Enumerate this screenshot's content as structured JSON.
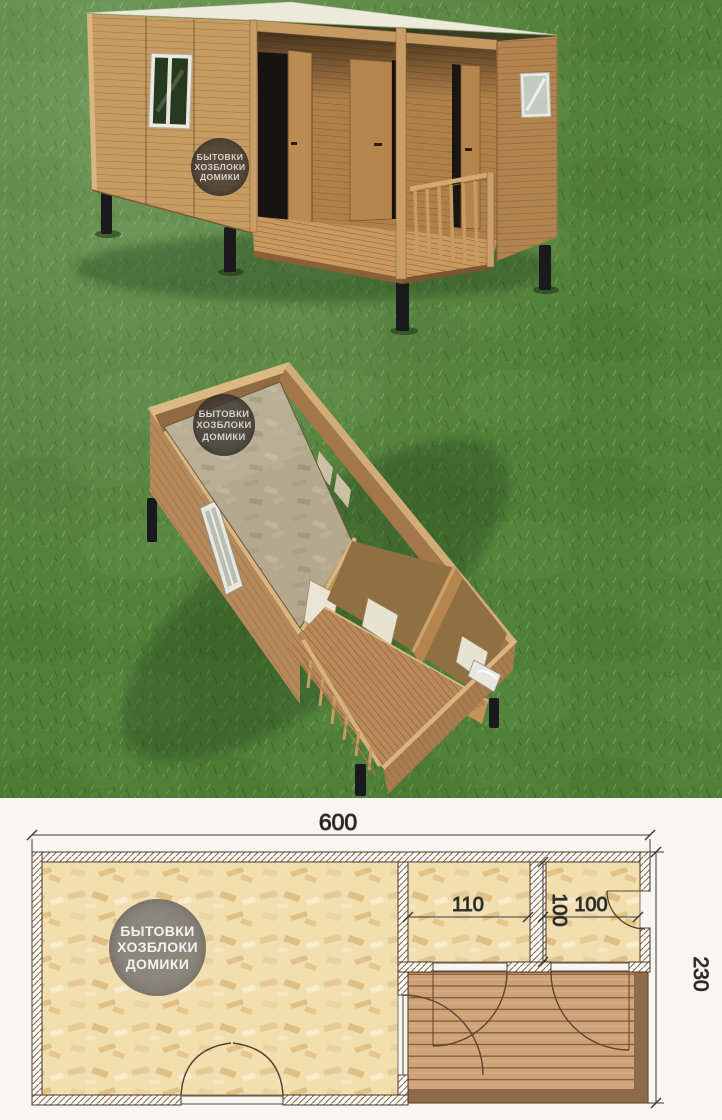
{
  "watermark": {
    "lines": [
      "БЫТОВКИ",
      "ХОЗБЛОКИ",
      "ДОМИКИ"
    ]
  },
  "plan": {
    "dim_width": "600",
    "dim_height": "230",
    "dim_room1_width": "110",
    "dim_room2_depth": "100",
    "dim_room2_width": "100"
  },
  "colors": {
    "grass": "#4f7f38",
    "wood": "#c49a62",
    "wood_shadow": "#a3774a",
    "roof": "#eceada",
    "legs": "#1a191d",
    "osb_floor": "#f1dfb0",
    "deck_plank": "#cfa379",
    "deck_frame": "#8d6a49",
    "wall_hatch": "#8a6a4d",
    "plan_background": "#f7f6f3",
    "dimension_text": "#1c1c1c",
    "watermark_render_bg": "#3e3831",
    "watermark_plan_bg": "#857f78"
  }
}
